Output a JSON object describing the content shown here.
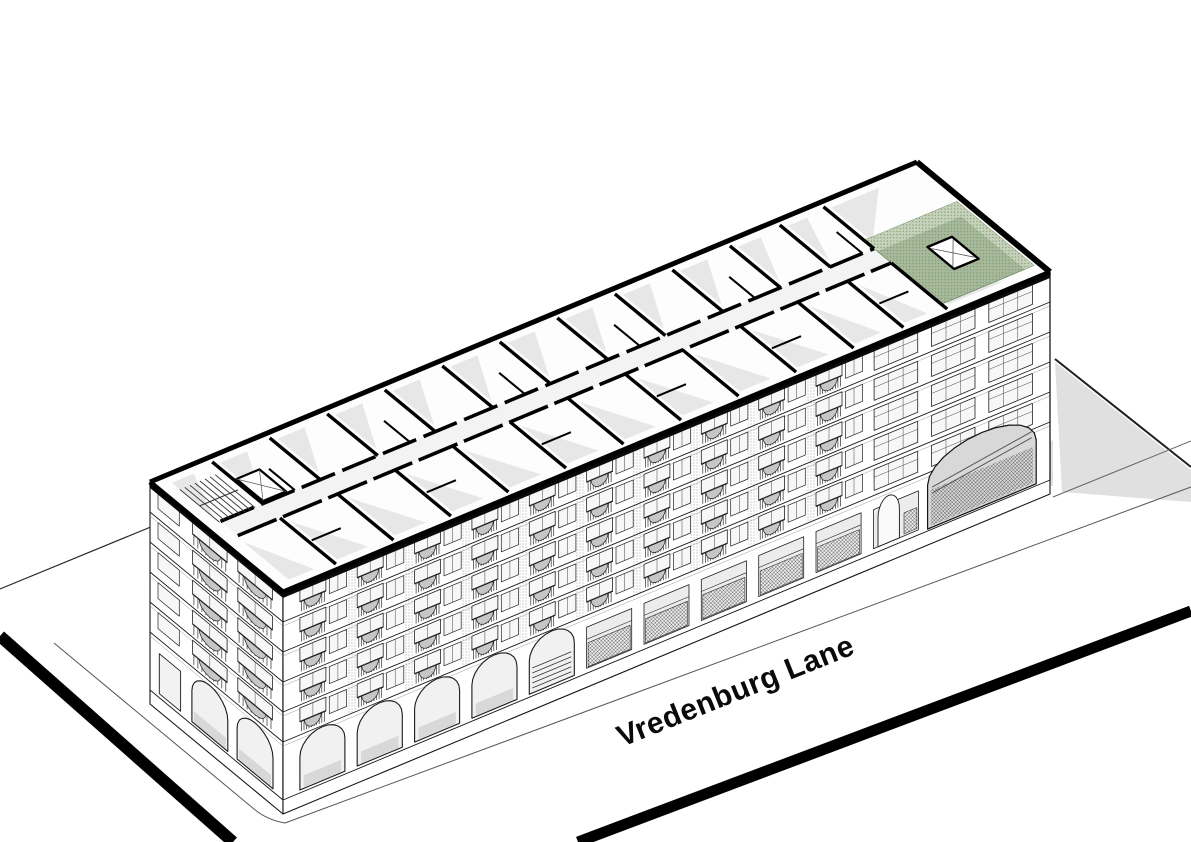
{
  "image": {
    "type": "axonometric cutaway architectural drawing",
    "background": "#ffffff",
    "description": "Isometric view of a perimeter-block apartment building with the top floor cut away to reveal its plan; one corner unit on the top floor is highlighted in green; the building fronts a street labelled Vredenburg Lane."
  },
  "street": {
    "label": "Vredenburg Lane",
    "angle_deg": -21.8
  },
  "colors": {
    "ink": "#161616",
    "wall_poche": "#000000",
    "floor_shadow": "#e7e7e7",
    "ground_shadow": "#e0e0e0",
    "cornice": "#9a9a9a",
    "glass": "#f7f7f7",
    "balcony_rail": "#2d2d2d",
    "balcony_front": "#c6c6c6",
    "grille": "#4a4a4a",
    "brick_stipple": "#8f8f8f",
    "arch_shade": "#d8d8d8",
    "green_floor": "#a7b99c",
    "green_wall": "#c7d2bd",
    "green_dot": "#77945f"
  },
  "building": {
    "floors_above_ground": 5,
    "front_units": 13,
    "balcony_unit_count": 10,
    "plain_tall_units": 3,
    "arcade_arches": 5,
    "storefront_units": 5,
    "gateway": "two-storey arched passage near street end",
    "end_bays": 2,
    "end_arches": 2,
    "highlighted_room": "green corner unit, top floor, street end"
  }
}
